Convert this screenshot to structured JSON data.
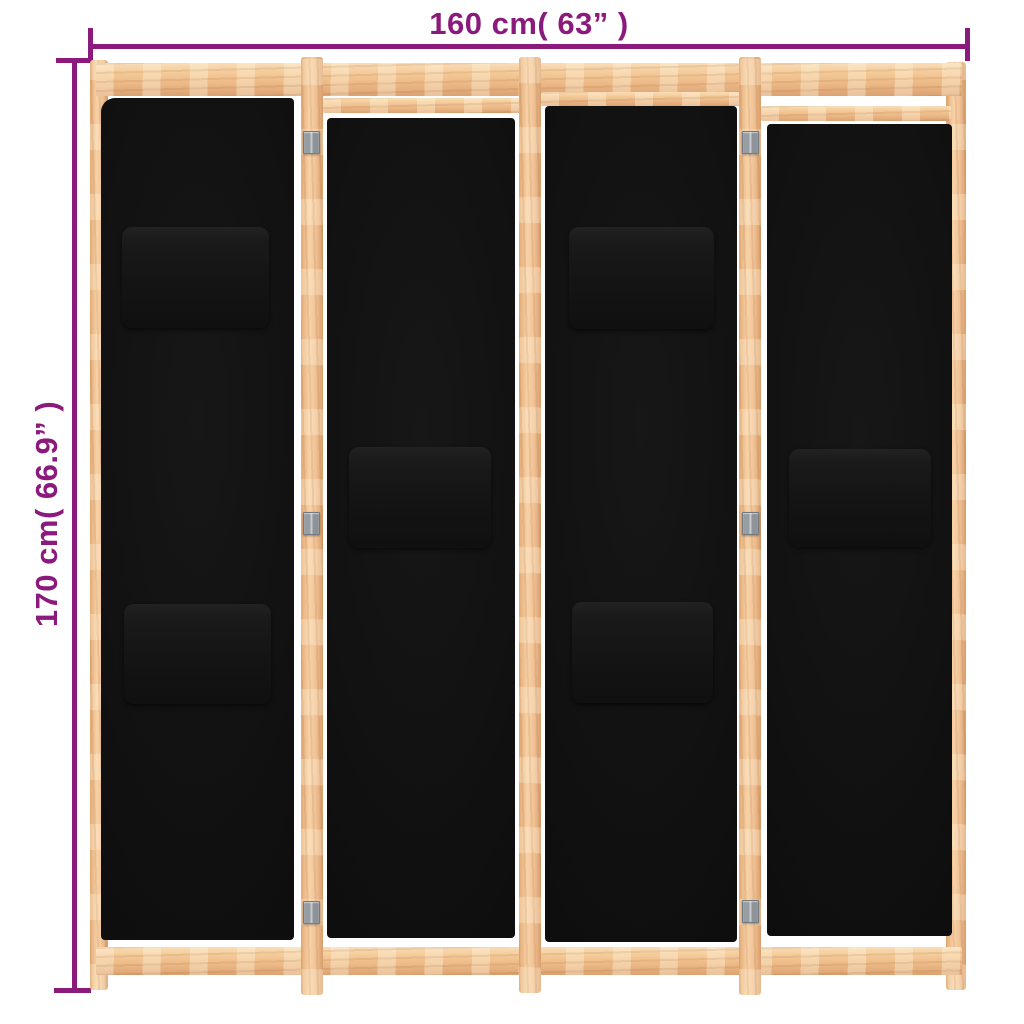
{
  "image": {
    "kind": "product dimension illustration",
    "background_color": "#ffffff",
    "description": "4-panel room divider, black fabric panels with pockets, light wooden frame, metal hinges"
  },
  "annotations": {
    "width_label": "160 cm( 63” )",
    "height_label": "170 cm( 66.9” )",
    "annotation_color": "#8b1a7c"
  },
  "product": {
    "panel_count": 4,
    "pocket_count": 6,
    "hinge_count": 6,
    "colors": {
      "wood_light": "#f7d2a7",
      "wood_mid": "#f0c296",
      "wood_shadow": "#d89d6a",
      "fabric": "#0e0e0e",
      "pocket": "#1a1a1a",
      "hinge_metal": "#9aa0a6"
    }
  }
}
